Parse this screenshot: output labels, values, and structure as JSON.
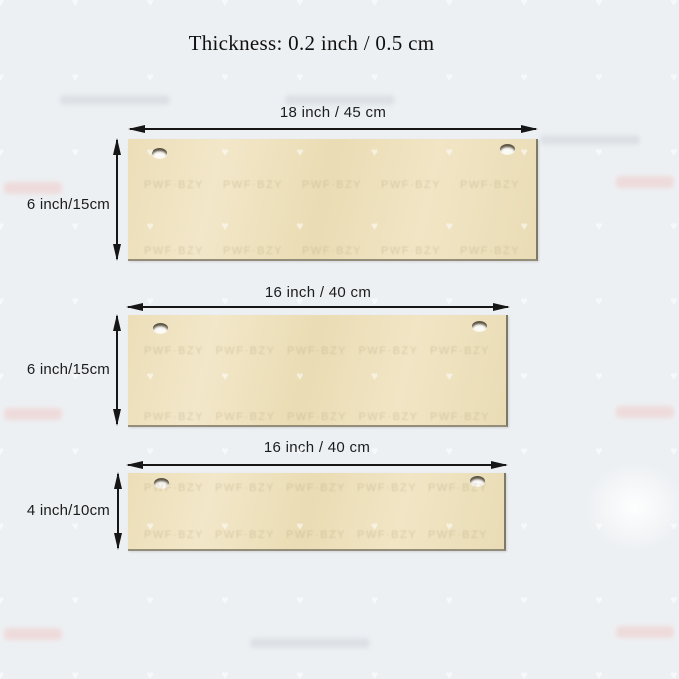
{
  "title": "Thickness: 0.2 inch / 0.5 cm",
  "boards": [
    {
      "width_label": "18 inch  /  45 cm",
      "height_label": "6 inch/15cm"
    },
    {
      "width_label": "16 inch  /  40 cm",
      "height_label": "6 inch/15cm"
    },
    {
      "width_label": "16 inch  /  40 cm",
      "height_label": "4 inch/10cm"
    }
  ],
  "watermark": {
    "text": "PWF·BZY"
  },
  "colors": {
    "background": "#edf0f3",
    "board": "#efe2c0",
    "board_edge": "#7e7867",
    "arrow": "#161616",
    "text": "#1c1c1c"
  }
}
